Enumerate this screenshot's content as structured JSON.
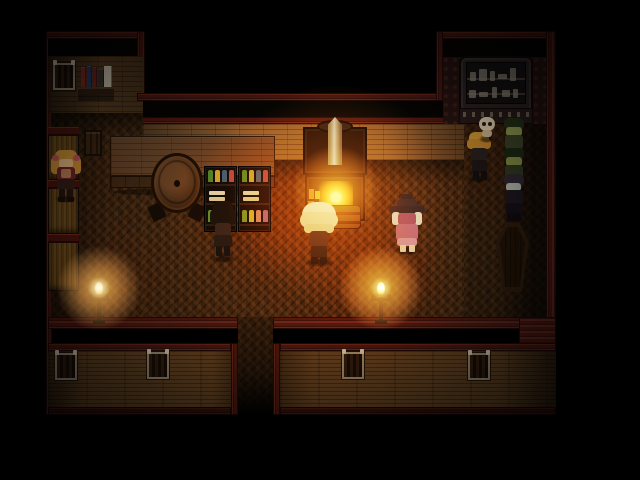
{
  "meta": {
    "domain": "game",
    "scene_name": "rpg-tavern-shop-interior-night",
    "style": "top-down pixel RPG (RPG Maker style)",
    "visible_text": "none"
  },
  "palette": {
    "bg": "#000000",
    "trim": "#451610",
    "trim_dark": "#200805",
    "wall_plank": "#644525",
    "wall_plank_lit": "#7d5a33",
    "south_plank": "#5d4123",
    "wallpaper": "#241210",
    "wallpaper_dot": "#3a1f16",
    "floor": "#37220f",
    "wood_table": "#5e422a",
    "cabinet": "#0e0906",
    "case_frame": "#2b2222",
    "case_inner": "#141010",
    "shelf_bar": "#47140e",
    "glow_warm": "#ffd88a",
    "fire_core": "#fff3c0",
    "fire_mid": "#ffb23a"
  },
  "scene": {
    "characters": [
      {
        "name": "girl-pigtails",
        "x": 52,
        "y": 148,
        "w": 28,
        "h": 54,
        "parts": [
          [
            3,
            2,
            22,
            13,
            "#c89a3e",
            6
          ],
          [
            -1,
            9,
            9,
            17,
            "#c89a3e",
            4
          ],
          [
            20,
            9,
            9,
            17,
            "#c89a3e",
            4
          ],
          [
            0,
            7,
            7,
            6,
            "#c05a6a",
            3
          ],
          [
            21,
            7,
            7,
            6,
            "#c05a6a",
            3
          ],
          [
            7,
            11,
            14,
            9,
            "#e8c9a0",
            3
          ],
          [
            5,
            19,
            18,
            13,
            "#6e2630",
            3
          ],
          [
            9,
            21,
            10,
            9,
            "#b88a6a",
            2
          ],
          [
            5,
            31,
            18,
            10,
            "#33201a",
            2
          ],
          [
            7,
            41,
            6,
            9,
            "#241610",
            1
          ],
          [
            15,
            41,
            6,
            9,
            "#241610",
            1
          ],
          [
            6,
            49,
            7,
            5,
            "#180e08",
            1
          ],
          [
            15,
            49,
            7,
            5,
            "#180e08",
            1
          ]
        ]
      },
      {
        "name": "bartender",
        "x": 208,
        "y": 200,
        "w": 30,
        "h": 62,
        "parts": [
          [
            5,
            1,
            20,
            14,
            "#15100c",
            6
          ],
          [
            2,
            9,
            26,
            16,
            "#15100c",
            5
          ],
          [
            7,
            23,
            16,
            14,
            "#2a2222",
            3
          ],
          [
            6,
            35,
            18,
            12,
            "#1e1816",
            2
          ],
          [
            8,
            46,
            6,
            10,
            "#141010",
            1
          ],
          [
            16,
            46,
            6,
            10,
            "#141010",
            1
          ]
        ]
      },
      {
        "name": "fluffy-white-hair",
        "x": 300,
        "y": 200,
        "w": 38,
        "h": 66,
        "parts": [
          [
            2,
            2,
            34,
            26,
            "#e4d9c0",
            14
          ],
          [
            0,
            12,
            38,
            16,
            "#d9cdb2",
            8
          ],
          [
            4,
            24,
            30,
            9,
            "#cfc3a8",
            4
          ],
          [
            10,
            31,
            18,
            16,
            "#2c2522",
            3
          ],
          [
            11,
            46,
            16,
            12,
            "#1c1714",
            2
          ],
          [
            11,
            57,
            7,
            7,
            "#120e0c",
            1
          ],
          [
            20,
            57,
            7,
            7,
            "#120e0c",
            1
          ]
        ]
      },
      {
        "name": "witch",
        "x": 388,
        "y": 194,
        "w": 38,
        "h": 60,
        "parts": [
          [
            13,
            0,
            12,
            9,
            "#221c24",
            3
          ],
          [
            9,
            5,
            20,
            10,
            "#2a222e",
            4
          ],
          [
            1,
            12,
            36,
            8,
            "#241e28",
            4
          ],
          [
            4,
            18,
            8,
            13,
            "#d6cec0",
            3
          ],
          [
            26,
            18,
            8,
            13,
            "#d6cec0",
            3
          ],
          [
            10,
            19,
            18,
            12,
            "#8a4878",
            3
          ],
          [
            8,
            30,
            22,
            16,
            "#a65f92",
            3
          ],
          [
            9,
            44,
            20,
            8,
            "#c389ad",
            3
          ],
          [
            12,
            51,
            6,
            7,
            "#d8c4b4",
            1
          ],
          [
            21,
            51,
            6,
            7,
            "#d8c4b4",
            1
          ]
        ]
      },
      {
        "name": "blonde-boy",
        "x": 465,
        "y": 132,
        "w": 28,
        "h": 50,
        "parts": [
          [
            4,
            0,
            20,
            13,
            "#c19a3c",
            6
          ],
          [
            2,
            7,
            24,
            10,
            "#b08a34",
            4
          ],
          [
            6,
            16,
            16,
            13,
            "#232026",
            3
          ],
          [
            7,
            28,
            15,
            12,
            "#191519",
            2
          ],
          [
            8,
            39,
            6,
            9,
            "#100d10",
            1
          ],
          [
            16,
            39,
            6,
            9,
            "#100d10",
            1
          ]
        ]
      },
      {
        "name": "skull-pet",
        "x": 477,
        "y": 116,
        "w": 20,
        "h": 26,
        "parts": [
          [
            2,
            1,
            16,
            14,
            "#d9d3c5",
            7
          ],
          [
            5,
            14,
            10,
            7,
            "#c3bdaf",
            3
          ],
          [
            5,
            6,
            4,
            4,
            "#231a12",
            2
          ],
          [
            11,
            6,
            4,
            4,
            "#231a12",
            2
          ]
        ]
      },
      {
        "name": "zombie-1",
        "x": 500,
        "y": 118,
        "w": 28,
        "h": 50,
        "parts": [
          [
            4,
            0,
            20,
            12,
            "#223317",
            5
          ],
          [
            6,
            9,
            16,
            9,
            "#87a05c",
            3
          ],
          [
            5,
            17,
            18,
            14,
            "#36452c",
            3
          ],
          [
            6,
            30,
            16,
            11,
            "#232e1c",
            2
          ],
          [
            7,
            40,
            6,
            8,
            "#161e12",
            1
          ],
          [
            15,
            40,
            6,
            8,
            "#161e12",
            1
          ]
        ]
      },
      {
        "name": "zombie-2",
        "x": 500,
        "y": 148,
        "w": 28,
        "h": 50,
        "parts": [
          [
            4,
            0,
            20,
            12,
            "#1a2a16",
            5
          ],
          [
            6,
            9,
            16,
            9,
            "#78914f",
            3
          ],
          [
            5,
            17,
            18,
            14,
            "#2c3a24",
            3
          ],
          [
            6,
            30,
            16,
            11,
            "#1d2718",
            2
          ],
          [
            7,
            40,
            6,
            8,
            "#121a0e",
            1
          ],
          [
            15,
            40,
            6,
            8,
            "#121a0e",
            1
          ]
        ]
      },
      {
        "name": "vampire",
        "x": 501,
        "y": 174,
        "w": 26,
        "h": 48,
        "parts": [
          [
            3,
            0,
            20,
            12,
            "#2c2738",
            5
          ],
          [
            5,
            9,
            15,
            8,
            "#a3b8bc",
            3
          ],
          [
            4,
            16,
            18,
            14,
            "#1b1722",
            3
          ],
          [
            5,
            29,
            16,
            11,
            "#130f18",
            2
          ],
          [
            6,
            39,
            6,
            8,
            "#0d0a10",
            1
          ],
          [
            14,
            39,
            6,
            8,
            "#0d0a10",
            1
          ]
        ]
      }
    ],
    "candles": [
      {
        "name": "candle-left",
        "x": 89,
        "y": 284
      },
      {
        "name": "candle-right",
        "x": 371,
        "y": 284
      }
    ],
    "lights": [
      {
        "name": "stove-core",
        "x": 336,
        "y": 190,
        "r": 48,
        "color": "#ffc860",
        "op": 0.65,
        "blend": "screen"
      },
      {
        "name": "stove-glow",
        "x": 336,
        "y": 196,
        "r": 120,
        "color": "#ff8c28",
        "op": 0.25,
        "blend": "screen"
      },
      {
        "name": "stove-halo",
        "x": 336,
        "y": 205,
        "r": 150,
        "color": "#ffae50",
        "op": 0.6,
        "blend": "ovl"
      },
      {
        "name": "room-glow",
        "x": 305,
        "y": 245,
        "r": 240,
        "color": "#c8883c",
        "op": 0.55,
        "blend": "ovl"
      },
      {
        "name": "counter-glow",
        "x": 247,
        "y": 205,
        "r": 90,
        "color": "#c8883c",
        "op": 0.5,
        "blend": "ovl"
      },
      {
        "name": "alcove-glow",
        "x": 488,
        "y": 160,
        "r": 80,
        "color": "#b07838",
        "op": 0.4,
        "blend": "ovl"
      },
      {
        "name": "west-glow",
        "x": 80,
        "y": 180,
        "r": 70,
        "color": "#a06830",
        "op": 0.35,
        "blend": "ovl"
      }
    ],
    "windows": [
      {
        "name": "north-window",
        "x": 53,
        "y": 63
      },
      {
        "name": "south-window-1",
        "x": 55,
        "y": 353
      },
      {
        "name": "south-window-2",
        "x": 147,
        "y": 352
      },
      {
        "name": "south-window-3",
        "x": 342,
        "y": 352
      },
      {
        "name": "south-window-4",
        "x": 468,
        "y": 353
      }
    ],
    "books": [
      [
        81,
        67,
        5,
        20,
        "#8d2822"
      ],
      [
        87,
        66,
        5,
        21,
        "#2c3a6e"
      ],
      [
        93,
        67,
        4,
        20,
        "#7c221c"
      ],
      [
        98,
        69,
        6,
        18,
        "#3a3430"
      ],
      [
        104,
        66,
        8,
        21,
        "#cfc6b0"
      ]
    ],
    "bottle_cabinets": [
      {
        "name": "bottle-cabinet-1",
        "x": 204,
        "y": 166
      },
      {
        "name": "bottle-cabinet-2",
        "x": 238,
        "y": 166
      }
    ],
    "bottle_rows": [
      {
        "dy": 2,
        "items": [
          "#3f7a2e",
          "#c09636",
          "#35548e",
          "#9c4054"
        ],
        "flat": false
      },
      {
        "dy": 21,
        "items": [
          "#cfc8b8",
          "#c4bcaa"
        ],
        "flat": true
      },
      {
        "dy": 42,
        "items": [
          "#49842f",
          "#bf9d3b",
          "#c07090",
          "#7a539e"
        ],
        "flat": false
      }
    ],
    "case_items": [
      [
        4,
        10,
        6,
        9
      ],
      [
        13,
        7,
        8,
        12
      ],
      [
        24,
        9,
        5,
        10
      ],
      [
        32,
        12,
        9,
        5
      ],
      [
        44,
        6,
        6,
        13
      ],
      [
        3,
        28,
        7,
        8
      ],
      [
        13,
        30,
        9,
        5
      ],
      [
        26,
        25,
        5,
        11
      ],
      [
        36,
        28,
        8,
        7
      ],
      [
        47,
        27,
        5,
        9
      ]
    ],
    "case_item_color": "#8d887a"
  }
}
